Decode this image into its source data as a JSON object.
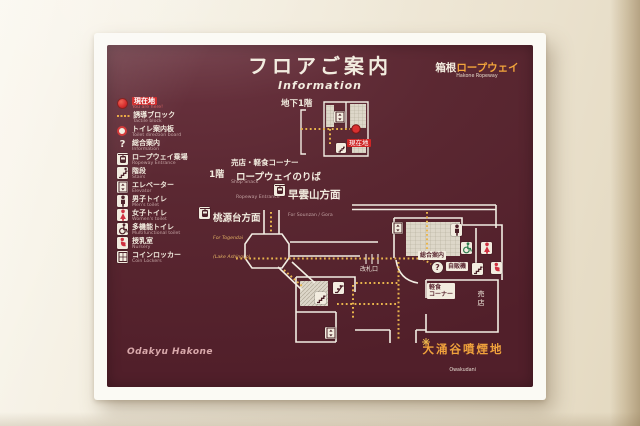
{
  "board": {
    "title_jp": "フロアご案内",
    "title_en": "Information",
    "brand": {
      "jp_prefix": "箱根",
      "jp_accent": "ロープウェイ",
      "en": "Hakone Ropeway"
    },
    "footer": "Odakyu Hakone"
  },
  "legend": {
    "items": [
      {
        "icon": "you-are-here-icon",
        "jp": "現在地",
        "en": "You are here!"
      },
      {
        "icon": "tactile-block-icon",
        "jp": "誘導ブロック",
        "en": "Tactile block"
      },
      {
        "icon": "toilet-direction-board-icon",
        "jp": "トイレ案内板",
        "en": "Toilet direction board"
      },
      {
        "icon": "information-icon",
        "jp": "総合案内",
        "en": "Information"
      },
      {
        "icon": "ropeway-entrance-icon",
        "jp": "ロープウェイ乗場",
        "en": "Ropeway Entrance"
      },
      {
        "icon": "stairs-icon",
        "jp": "階段",
        "en": "Stairs"
      },
      {
        "icon": "elevator-icon",
        "jp": "エレベーター",
        "en": "Elevator"
      },
      {
        "icon": "mens-toilet-icon",
        "jp": "男子トイレ",
        "en": "Men's toilet"
      },
      {
        "icon": "womens-toilet-icon",
        "jp": "女子トイレ",
        "en": "Women's toilet"
      },
      {
        "icon": "multifunctional-toilet-icon",
        "jp": "多機能トイレ",
        "en": "Multifunctional toilet"
      },
      {
        "icon": "nursery-icon",
        "jp": "授乳室",
        "en": "Nursery"
      },
      {
        "icon": "coin-lockers-icon",
        "jp": "コインロッカー",
        "en": "Coin Lockers"
      }
    ]
  },
  "map": {
    "labels": {
      "b1f": "地下1階",
      "you_are_here": "現在地",
      "shop_snack_jp": "売店・軽食コーナー",
      "shop_snack_en": "Shop Snack",
      "f1": "1階",
      "ropeway_boarding_jp": "ロープウェイのりば",
      "ropeway_boarding_en": "Ropeway Entrance",
      "sounzan_jp": "早雲山方面",
      "sounzan_en": "For Sounzan / Gora",
      "togendai_jp": "桃源台方面",
      "togendai_en1": "For Togendai",
      "togendai_en2": "(Lake Ashinoko)",
      "ticket_gate": "改札口",
      "information_desk": "総合案内",
      "vending_machine": "自販機",
      "snack_line1": "軽食",
      "snack_line2": "コーナー",
      "shop": "売店",
      "owakudani_jp": "大涌谷噴煙地",
      "owakudani_en": "Owakudani"
    },
    "colors": {
      "board_maroon": "#5b2832",
      "accent_orange": "#f2a43b",
      "tactile_yellow": "#e9b54d",
      "marker_red": "#d42020",
      "line_white": "#f2ede3"
    }
  }
}
